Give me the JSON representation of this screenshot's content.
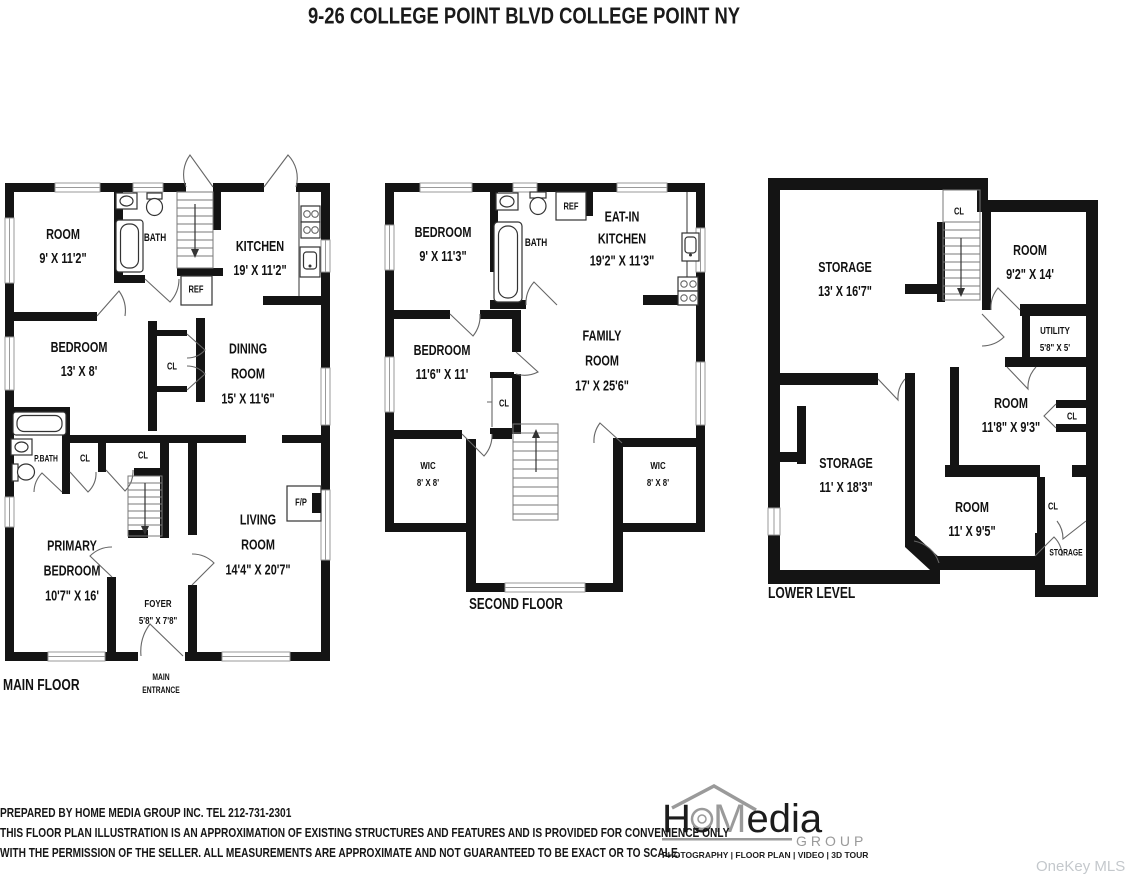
{
  "title": "9-26 COLLEGE POINT BLVD COLLEGE POINT NY",
  "colors": {
    "wall": "#141414",
    "background": "#ffffff",
    "logo_gray": "#9a9a9a",
    "watermark_gray": "#c4c8cc"
  },
  "floors": {
    "main": {
      "label": "MAIN FLOOR",
      "rooms": {
        "room1": {
          "name": "ROOM",
          "dims": "9' X 11'2\""
        },
        "bath": {
          "name": "BATH"
        },
        "kitchen": {
          "name": "KITCHEN",
          "dims": "19' X 11'2\""
        },
        "ref": {
          "name": "REF"
        },
        "bedroom": {
          "name": "BEDROOM",
          "dims": "13' X 8'"
        },
        "cl_hall": {
          "name": "CL"
        },
        "dining": {
          "line1": "DINING",
          "line2": "ROOM",
          "dims": "15' X 11'6\""
        },
        "pbath": {
          "name": "P.BATH"
        },
        "cl_1": {
          "name": "CL"
        },
        "cl_2": {
          "name": "CL"
        },
        "primary": {
          "line1": "PRIMARY",
          "line2": "BEDROOM",
          "dims": "10'7\" X 16'"
        },
        "foyer": {
          "name": "FOYER",
          "dims": "5'8\" X 7'8\""
        },
        "living": {
          "line1": "LIVING",
          "line2": "ROOM",
          "dims": "14'4\" X 20'7\""
        },
        "fireplace": {
          "name": "F/P"
        },
        "entrance": {
          "line1": "MAIN",
          "line2": "ENTRANCE"
        }
      }
    },
    "second": {
      "label": "SECOND FLOOR",
      "rooms": {
        "bedroom1": {
          "name": "BEDROOM",
          "dims": "9' X 11'3\""
        },
        "bath": {
          "name": "BATH"
        },
        "ref": {
          "name": "REF"
        },
        "kitchen": {
          "line1": "EAT-IN",
          "line2": "KITCHEN",
          "dims": "19'2\" X 11'3\""
        },
        "bedroom2": {
          "name": "BEDROOM",
          "dims": "11'6\" X 11'"
        },
        "cl": {
          "name": "CL"
        },
        "family": {
          "line1": "FAMILY",
          "line2": "ROOM",
          "dims": "17' X 25'6\""
        },
        "wic_left": {
          "name": "WIC",
          "dims": "8' X 8'"
        },
        "wic_right": {
          "name": "WIC",
          "dims": "8' X 8'"
        }
      }
    },
    "lower": {
      "label": "LOWER LEVEL",
      "rooms": {
        "storage1": {
          "name": "STORAGE",
          "dims": "13' X 16'7\""
        },
        "cl_top": {
          "name": "CL"
        },
        "room1": {
          "name": "ROOM",
          "dims": "9'2\" X 14'"
        },
        "utility": {
          "name": "UTILITY",
          "dims": "5'8\" X 5'"
        },
        "room2": {
          "name": "ROOM",
          "dims": "11'8\" X 9'3\""
        },
        "cl_mid": {
          "name": "CL"
        },
        "storage2": {
          "name": "STORAGE",
          "dims": "11' X 18'3\""
        },
        "room3": {
          "name": "ROOM",
          "dims": "11' X 9'5\""
        },
        "cl_low": {
          "name": "CL"
        },
        "storage3": {
          "name": "STORAGE"
        }
      }
    }
  },
  "footer": {
    "line1": "PREPARED BY  HOME MEDIA GROUP INC.  TEL 212-731-2301",
    "line2": "THIS FLOOR PLAN ILLUSTRATION IS AN APPROXIMATION OF EXISTING STRUCTURES AND FEATURES AND IS PROVIDED FOR CONVENIENCE ONLY",
    "line3": "WITH THE PERMISSION OF THE SELLER. ALL MEASUREMENTS ARE APPROXIMATE AND NOT GUARANTEED TO BE EXACT OR TO SCALE."
  },
  "logo": {
    "ho": "Ho",
    "m": "M",
    "edia": "edia",
    "group": "GROUP",
    "tagline": "PHOTOGRAPHY | FLOOR PLAN | VIDEO | 3D TOUR"
  },
  "watermark": "OneKey MLS"
}
